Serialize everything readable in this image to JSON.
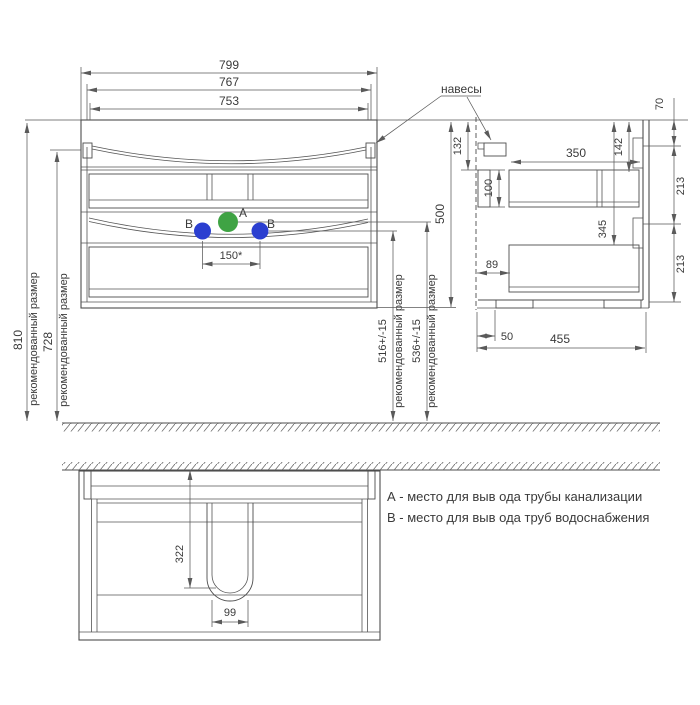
{
  "colors": {
    "line": "#4d4d4d",
    "text": "#3a3a3a",
    "drain_a_green": "#3fa344",
    "water_b_blue": "#2b3fd0"
  },
  "front_view": {
    "dim_799": "799",
    "dim_767": "767",
    "dim_753": "753",
    "dim_150": "150*",
    "label_a": "A",
    "label_b_left": "B",
    "label_b_right": "B"
  },
  "height_dims": {
    "dim_810": "810",
    "note_810": "рекомендованный размер",
    "dim_728": "728",
    "note_728": "рекомендованный размер",
    "dim_516": "516+/-15",
    "note_516": "рекомендованный размер",
    "dim_536": "536+/-15",
    "note_536": "рекомендованный размер"
  },
  "side_view": {
    "hangers_label": "навесы",
    "dim_500": "500",
    "dim_132": "132",
    "dim_100": "100",
    "dim_350": "350",
    "dim_142": "142",
    "dim_345": "345",
    "dim_70": "70",
    "dim_213_upper": "213",
    "dim_213_lower": "213",
    "dim_89": "89",
    "dim_50": "50",
    "dim_455": "455"
  },
  "bottom_view": {
    "dim_322": "322",
    "dim_99": "99"
  },
  "legend": {
    "line_a": "А - место для выв ода трубы канализации",
    "line_b": "В - место для выв ода труб водоснабжения"
  }
}
